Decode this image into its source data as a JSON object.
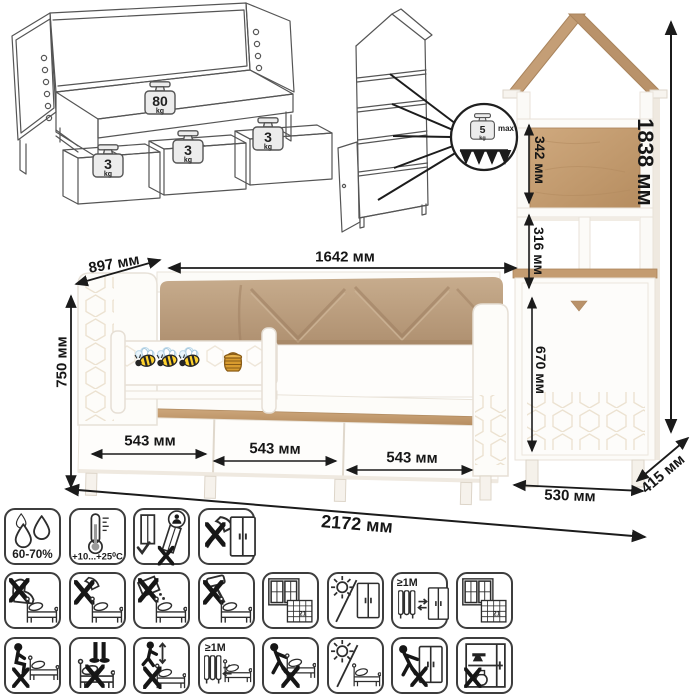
{
  "wire_bed": {
    "bed_load": "80",
    "drawer_load": "3",
    "unit": "kg"
  },
  "wire_cabinet": {
    "shelf_load": "5",
    "unit": "kg",
    "max_label": "max"
  },
  "dims": {
    "d897": "897 мм",
    "d1642": "1642 мм",
    "d750": "750 мм",
    "d543a": "543 мм",
    "d543b": "543 мм",
    "d543c": "543 мм",
    "d2172": "2172 мм",
    "d1838": "1838 мм",
    "d342": "342 мм",
    "d316": "316 мм",
    "d670": "670 мм",
    "d530": "530 мм",
    "d415": "415 мм"
  },
  "care": {
    "row1": [
      {
        "name": "humidity-range",
        "label": "60-70%"
      },
      {
        "name": "temperature-range",
        "label": "+10...+25⁰C"
      },
      {
        "name": "assemble-upright-only",
        "label": ""
      },
      {
        "name": "no-sharp-tools-wardrobe",
        "label": ""
      }
    ],
    "row2": [
      {
        "name": "no-shoes-on-bed"
      },
      {
        "name": "no-axe-on-bed"
      },
      {
        "name": "no-spills-on-bed"
      },
      {
        "name": "no-hammer-on-bed"
      },
      {
        "name": "ventilate-room-bed",
        "cal": "21"
      },
      {
        "name": "no-direct-sunlight-wardrobe"
      },
      {
        "name": "keep-1m-from-heater-wardrobe",
        "label": "≥1М"
      },
      {
        "name": "ventilate-room-wardrobe",
        "cal": "21"
      }
    ],
    "row3": [
      {
        "name": "no-sitting-on-bed-edge"
      },
      {
        "name": "no-standing-on-bed"
      },
      {
        "name": "no-jumping-on-bed"
      },
      {
        "name": "keep-1m-from-heater-bed",
        "label": "≥1М"
      },
      {
        "name": "no-dragging-bed"
      },
      {
        "name": "no-direct-sunlight-bed"
      },
      {
        "name": "no-dragging-wardrobe"
      },
      {
        "name": "no-heavy-items-in-wardrobe"
      }
    ]
  }
}
